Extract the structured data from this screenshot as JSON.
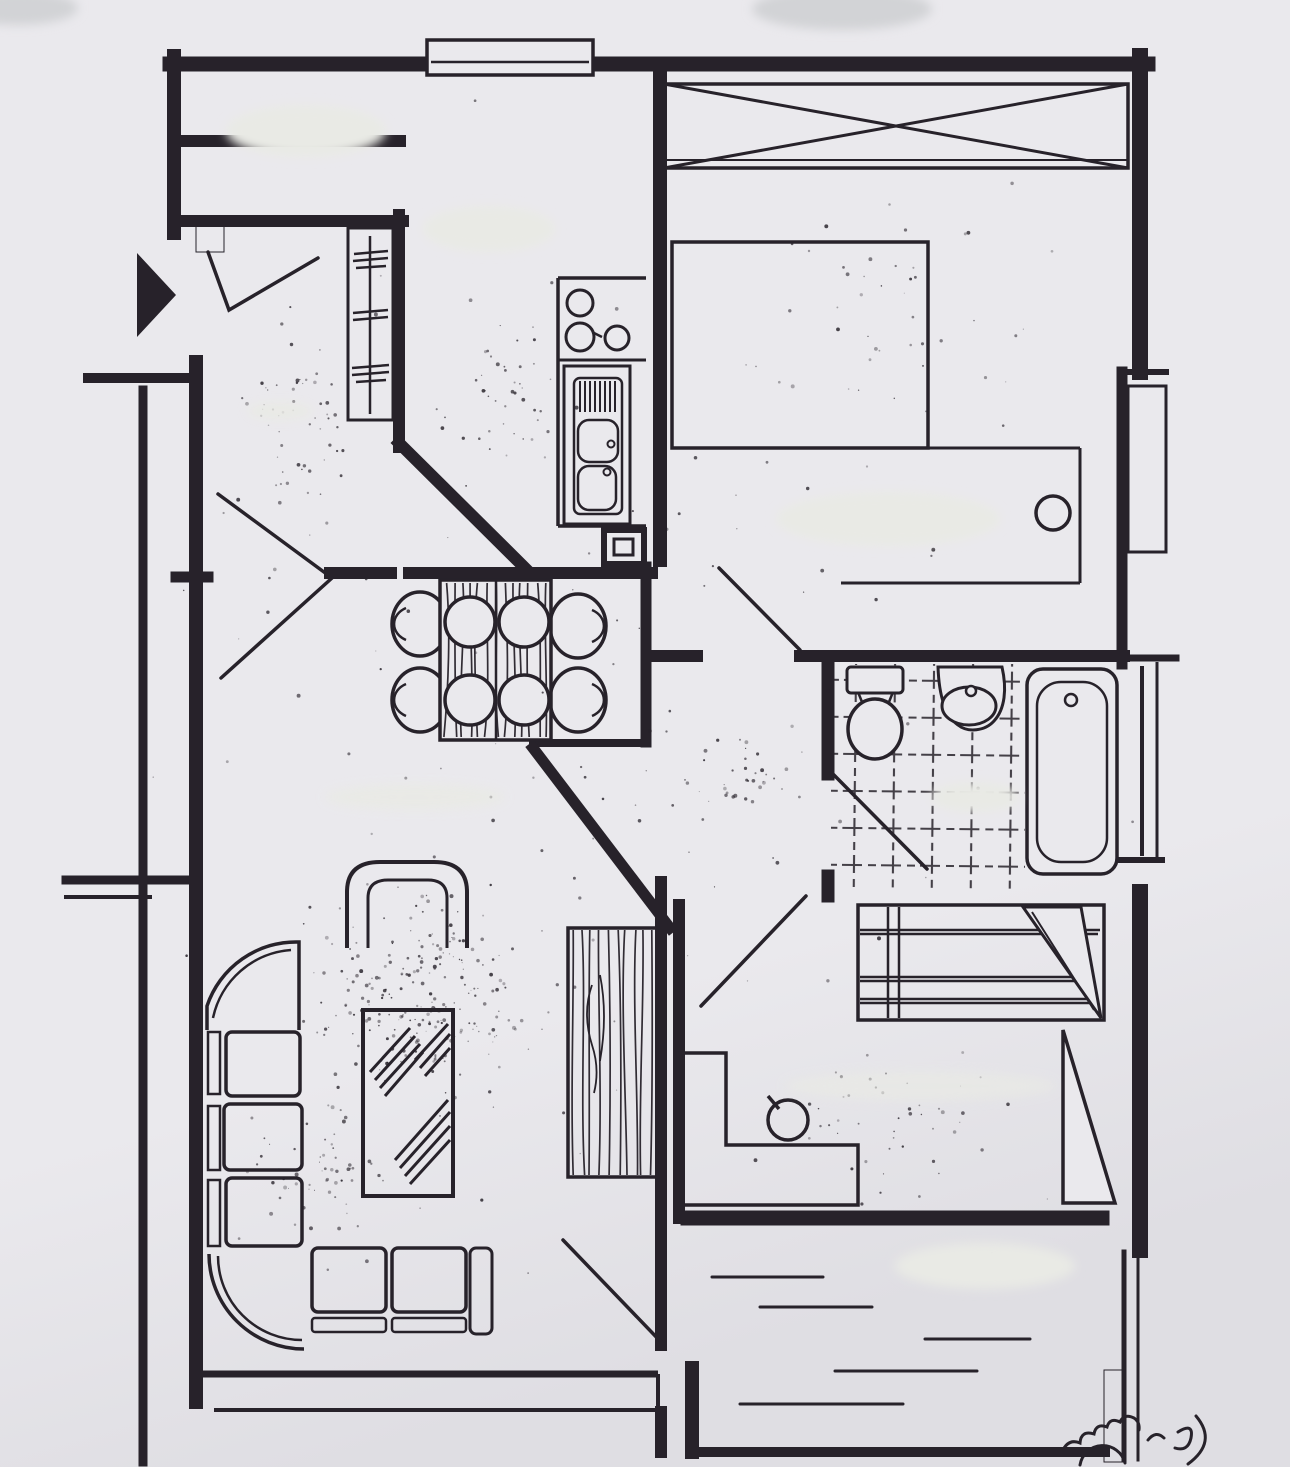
{
  "document": {
    "type": "floor-plan",
    "aria_label": "Hand-drawn apartment floor plan, ink on paper, all room labels erased with white smudges",
    "style": "hand-drawn architectural sketch, photographed page",
    "labels_visible": false
  },
  "colors": {
    "paper": "#eae9ed",
    "paper_edge": "#dfdee3",
    "ink": "#27222a",
    "redaction": "#e9eae5",
    "corner_smudge": "#d2d3d6"
  },
  "rooms": [
    {
      "name": "entrance-hall",
      "features": [
        "entry-door-swing",
        "coat-closet-with-rail",
        "erased-label"
      ]
    },
    {
      "name": "kitchen",
      "features": [
        "counter",
        "stove-3-burners",
        "double-sink-with-drainboard",
        "small-appliance",
        "erased-label"
      ]
    },
    {
      "name": "dining-nook",
      "features": [
        "wood-table",
        "four-plates",
        "four-chairs"
      ]
    },
    {
      "name": "bedroom-1",
      "features": [
        "built-in-wardrobe-x-symbol",
        "double-bed",
        "side-table",
        "round-stool",
        "erased-label"
      ]
    },
    {
      "name": "bathroom",
      "features": [
        "toilet",
        "washbasin",
        "bathtub",
        "tiled-floor",
        "door-swing",
        "erased-label"
      ]
    },
    {
      "name": "hallway",
      "features": [
        "door-swings-to-three-rooms"
      ]
    },
    {
      "name": "living-room",
      "features": [
        "corner-sofa",
        "armchair",
        "glass-coffee-table",
        "wood-sideboard",
        "window-front",
        "balcony-door",
        "erased-label"
      ]
    },
    {
      "name": "bedroom-2",
      "features": [
        "single-bed-with-folded-blanket",
        "l-shaped-desk",
        "round-stool",
        "curtain-or-door-triangle",
        "erased-label"
      ]
    },
    {
      "name": "balcony",
      "features": [
        "deck-plank-dashes",
        "plant-doodle",
        "railing",
        "erased-label"
      ]
    }
  ],
  "symbols": {
    "entrance_arrow": "solid black triangle pointing right at the flat entrance",
    "wardrobe_x": "rectangle with crossed diagonals = built-in wardrobe",
    "coat_rail": "vertical line with tick marks inside hall closet",
    "door_swing": "straight diagonal leaf lines",
    "glass_hatch": "diagonal line clusters on coffee table",
    "wood_grain": "wavy vertical stripes on table and sideboard"
  },
  "generated": {
    "seed": 20177,
    "speckle_clusters": [
      {
        "cx": 420,
        "cy": 995,
        "rx": 150,
        "ry": 140,
        "n": 230
      },
      {
        "cx": 320,
        "cy": 1180,
        "rx": 120,
        "ry": 110,
        "n": 70
      },
      {
        "cx": 290,
        "cy": 430,
        "rx": 85,
        "ry": 170,
        "n": 60
      },
      {
        "cx": 500,
        "cy": 390,
        "rx": 80,
        "ry": 110,
        "n": 40
      },
      {
        "cx": 900,
        "cy": 290,
        "rx": 190,
        "ry": 170,
        "n": 40
      },
      {
        "cx": 745,
        "cy": 770,
        "rx": 65,
        "ry": 95,
        "n": 30
      },
      {
        "cx": 930,
        "cy": 1110,
        "rx": 170,
        "ry": 110,
        "n": 45
      },
      {
        "cx": 645,
        "cy": 730,
        "rx": 590,
        "ry": 690,
        "n": 130
      }
    ],
    "deck_lines": [
      [
        712,
        1277,
        823,
        1277
      ],
      [
        760,
        1307,
        872,
        1307
      ],
      [
        925,
        1339,
        1030,
        1339
      ],
      [
        835,
        1371,
        977,
        1371
      ],
      [
        740,
        1404,
        903,
        1404
      ]
    ],
    "redactions": [
      {
        "cx": 306,
        "cy": 131,
        "rx": 80,
        "ry": 26,
        "tone": "light",
        "opacity": 1
      },
      {
        "cx": 489,
        "cy": 229,
        "rx": 66,
        "ry": 23,
        "tone": "light",
        "opacity": 1
      },
      {
        "cx": 888,
        "cy": 519,
        "rx": 112,
        "ry": 27,
        "tone": "light",
        "opacity": 1
      },
      {
        "cx": 975,
        "cy": 797,
        "rx": 44,
        "ry": 15,
        "tone": "light",
        "opacity": 1
      },
      {
        "cx": 415,
        "cy": 797,
        "rx": 90,
        "ry": 13,
        "tone": "light",
        "opacity": 0.85
      },
      {
        "cx": 920,
        "cy": 1086,
        "rx": 135,
        "ry": 15,
        "tone": "light",
        "opacity": 0.7
      },
      {
        "cx": 985,
        "cy": 1266,
        "rx": 90,
        "ry": 23,
        "tone": "light",
        "opacity": 1
      },
      {
        "cx": 280,
        "cy": 411,
        "rx": 33,
        "ry": 9,
        "tone": "light",
        "opacity": 0.9
      },
      {
        "cx": 18,
        "cy": 8,
        "rx": 60,
        "ry": 17,
        "tone": "gray",
        "opacity": 1
      },
      {
        "cx": 842,
        "cy": 9,
        "rx": 90,
        "ry": 21,
        "tone": "gray",
        "opacity": 1
      }
    ],
    "grain_regions": [
      {
        "x": 441,
        "y": 581,
        "w": 109,
        "h": 158,
        "lines": 13,
        "name": "dining-table-grain"
      },
      {
        "x": 568,
        "y": 928,
        "w": 89,
        "h": 249,
        "lines": 10,
        "name": "sideboard-grain"
      }
    ]
  }
}
